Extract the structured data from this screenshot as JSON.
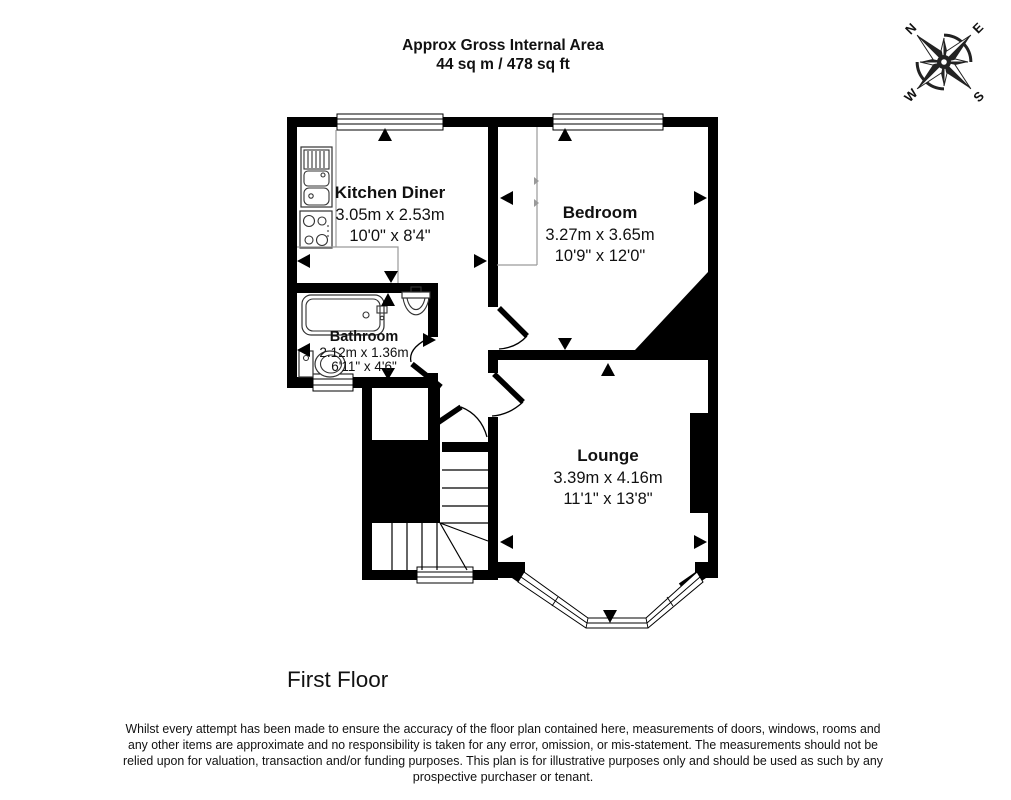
{
  "title": {
    "line1": "Approx Gross Internal Area",
    "line2": "44 sq m / 478 sq ft"
  },
  "floor_label": "First Floor",
  "compass": {
    "n": "N",
    "e": "E",
    "s": "S",
    "w": "W"
  },
  "rooms": [
    {
      "name": "Kitchen Diner",
      "metric": "3.05m x 2.53m",
      "imperial": "10'0\" x 8'4\""
    },
    {
      "name": "Bedroom",
      "metric": "3.27m x 3.65m",
      "imperial": "10'9\" x 12'0\""
    },
    {
      "name": "Bathroom",
      "metric": "2.12m x 1.36m",
      "imperial": "6'11\" x 4'6\""
    },
    {
      "name": "Lounge",
      "metric": "3.39m x 4.16m",
      "imperial": "11'1\" x 13'8\""
    }
  ],
  "disclaimer": {
    "lines": [
      "Whilst every attempt has been made to ensure the accuracy of the floor plan contained here, measurements of doors, windows, rooms and",
      "any other items are approximate and no responsibility is taken for any error, omission, or mis-statement. The measurements should not be",
      "relied upon for valuation, transaction and/or funding purposes. This plan is for illustrative purposes only and should be used as such by any",
      "prospective purchaser or tenant."
    ]
  },
  "colors": {
    "wall": "#000000",
    "background": "#ffffff",
    "light_line": "#9a9a9a"
  }
}
